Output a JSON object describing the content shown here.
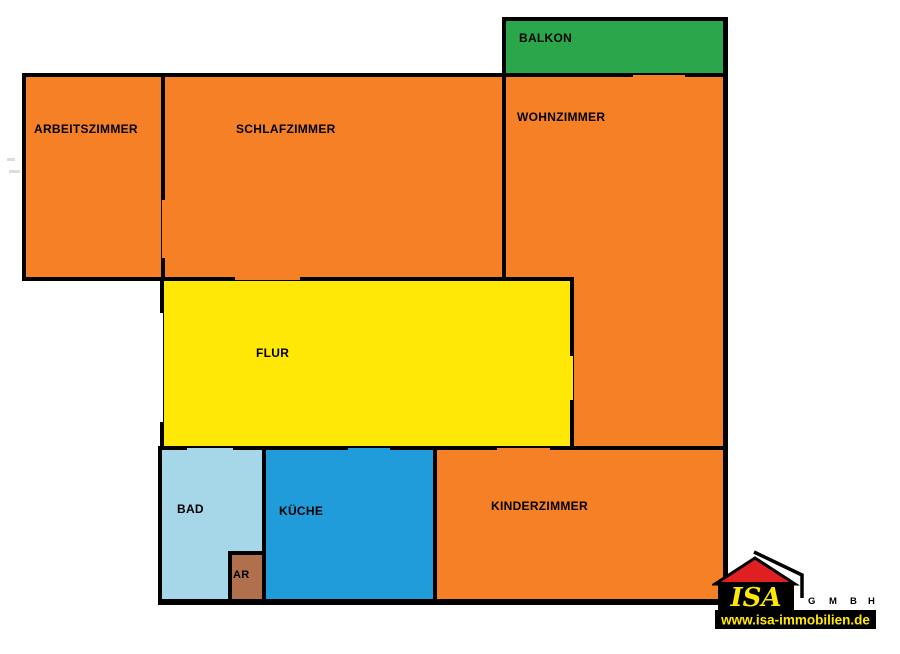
{
  "document": {
    "type": "apartment floor plan",
    "background": "#FFFFFF",
    "wall_color": "#000000"
  },
  "rooms": {
    "balkon": {
      "label": "BALKON",
      "color": "#2BA64A"
    },
    "arbeitszimmer": {
      "label": "ARBEITSZIMMER",
      "color": "#F58025"
    },
    "schlafzimmer": {
      "label": "SCHLAFZIMMER",
      "color": "#F58025"
    },
    "wohnzimmer": {
      "label": "WOHNZIMMER",
      "color": "#F58025"
    },
    "flur": {
      "label": "FLUR",
      "color": "#FFE805"
    },
    "bad": {
      "label": "BAD",
      "color": "#A6D7E8"
    },
    "kueche": {
      "label": "KÜCHE",
      "color": "#1F9CD9"
    },
    "ar": {
      "label": "AR",
      "color": "#B06F4D"
    },
    "kinderzimmer": {
      "label": "KINDERZIMMER",
      "color": "#F58025"
    }
  },
  "logo": {
    "name": "ISA",
    "suffix_letters": [
      "G",
      "M",
      "B",
      "H"
    ],
    "website": "www.isa-immobilien.de",
    "colors": {
      "roof": "#E02020",
      "letters": "#FFE805",
      "bar": "#000000"
    }
  }
}
